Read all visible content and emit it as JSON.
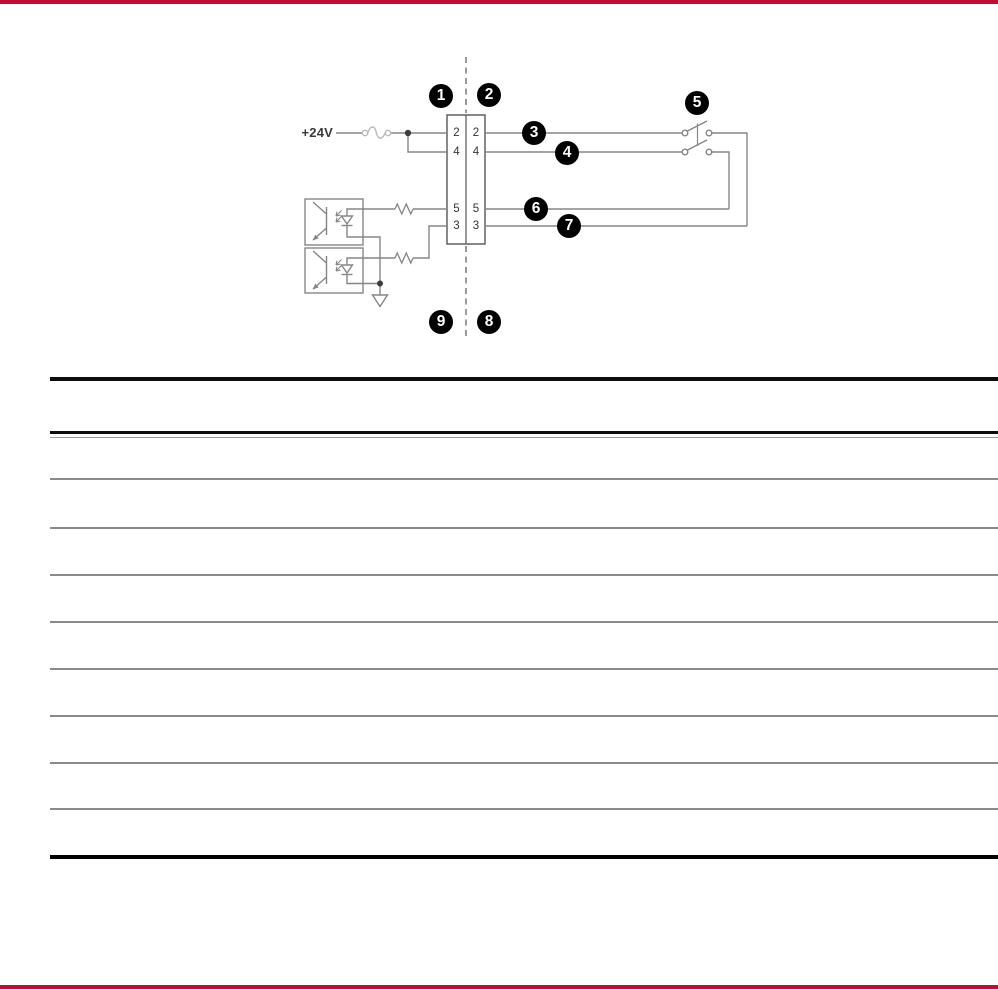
{
  "page": {
    "accent_color": "#C00D33",
    "background_color": "#ffffff"
  },
  "diagram": {
    "supply_label": "+24V",
    "terminal_block": {
      "left_pins": [
        "2",
        "4",
        "5",
        "3"
      ],
      "right_pins": [
        "2",
        "4",
        "5",
        "3"
      ]
    },
    "callouts": [
      "1",
      "2",
      "3",
      "4",
      "5",
      "6",
      "7",
      "8",
      "9"
    ],
    "callout_colors": {
      "background": "#000000",
      "text": "#ffffff"
    },
    "wire_color": "#868686"
  },
  "legend_table": {
    "header_text": "",
    "rows": [
      "",
      "",
      "",
      "",
      "",
      "",
      "",
      "",
      ""
    ]
  }
}
